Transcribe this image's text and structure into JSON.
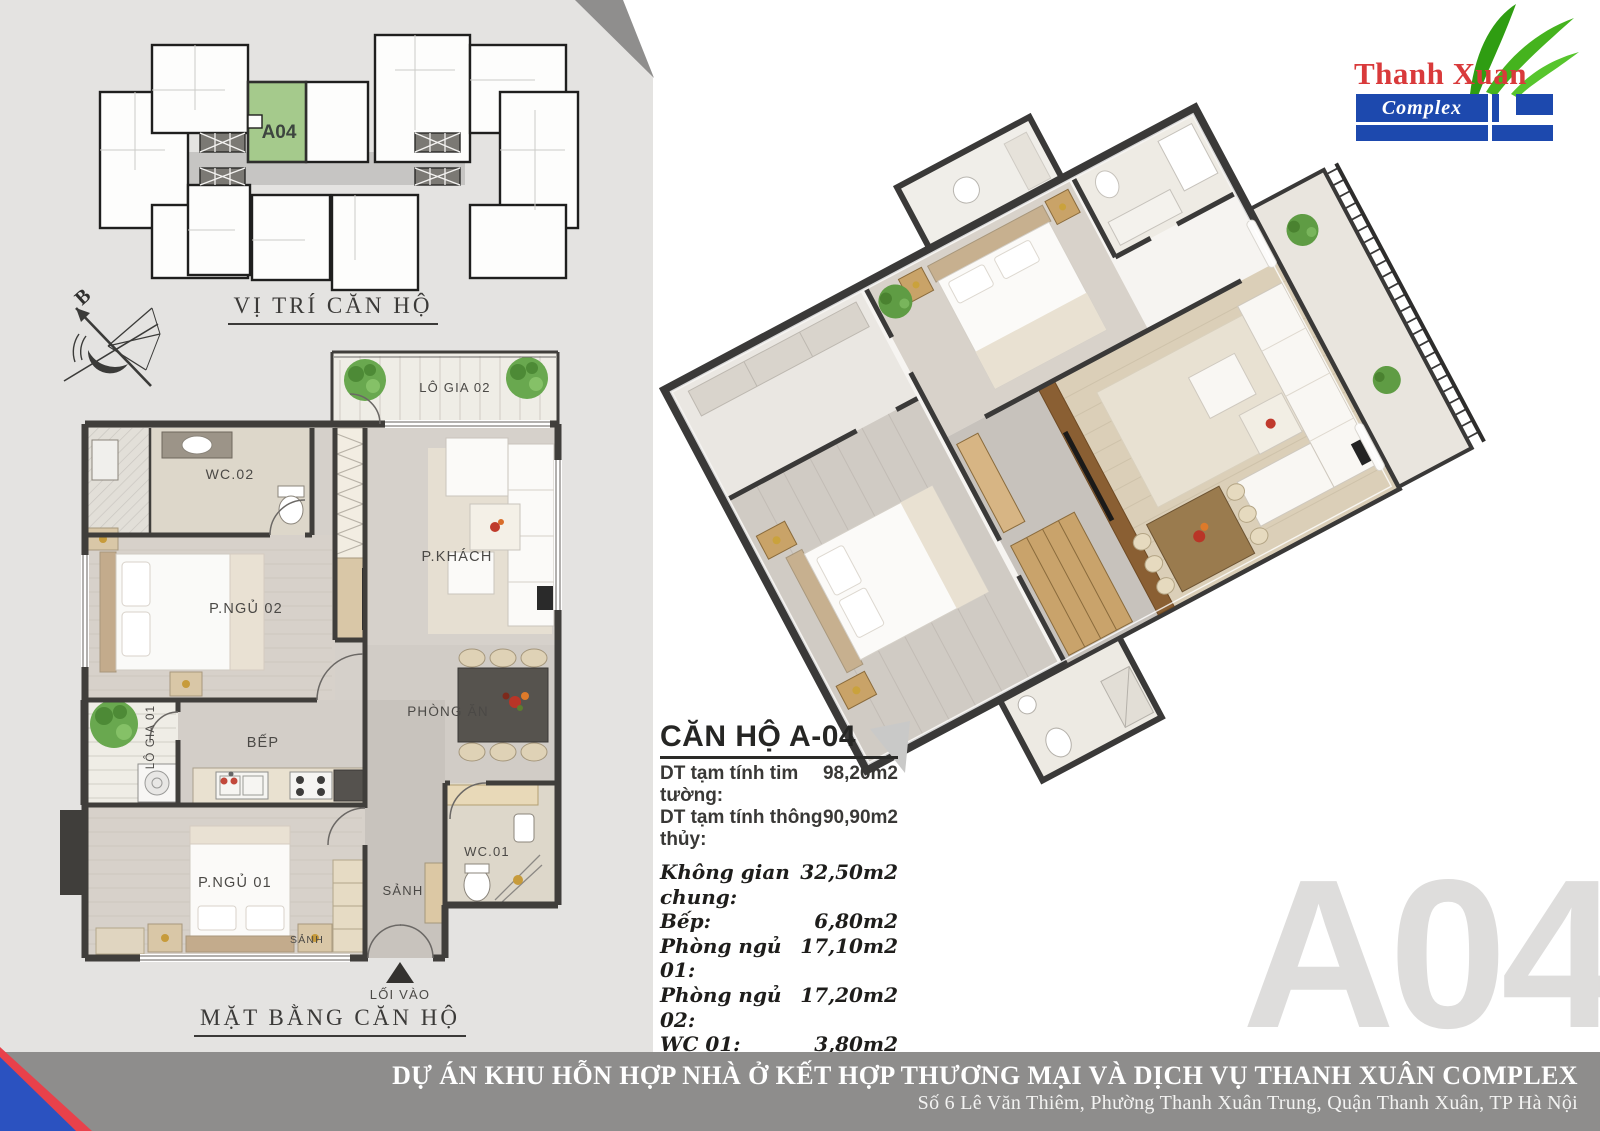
{
  "colors": {
    "panel_bg": "#e4e3e1",
    "banner_bg": "#8e8d8c",
    "logo_blue": "#1d49ae",
    "logo_red": "#d93a3b",
    "leaf_green": "#45b31e",
    "unit_highlight_green": "#a5ca8c",
    "corner_blue": "#2b52c0",
    "corner_red": "#e8414b",
    "watermark_gray": "#dedddc"
  },
  "logo": {
    "name": "Thanh Xuan",
    "sub": "Complex"
  },
  "location_map": {
    "title": "VỊ TRÍ CĂN HỘ",
    "highlighted_unit": "A04"
  },
  "compass": {
    "north_label": "B"
  },
  "floorplan": {
    "title": "MẶT BẰNG CĂN HỘ",
    "rooms": {
      "balcony2": "LÔ GIA 02",
      "wc2": "WC.02",
      "living": "P.KHÁCH",
      "bedroom2": "P.NGỦ 02",
      "dining": "PHÒNG ĂN",
      "kitchen": "BẾP",
      "balcony1": "LÔ GIA 01",
      "bedroom1": "P.NGỦ 01",
      "hall": "SẢNH",
      "hall_small": "SẢNH",
      "wc1": "WC.01",
      "entrance": "LỐI VÀO"
    }
  },
  "unit_info": {
    "title": "CĂN HỘ A-04",
    "rows": [
      {
        "label": "DT tạm tính tim tường:",
        "value": "98,20m2"
      },
      {
        "label": "DT tạm tính thông thủy:",
        "value": "90,90m2"
      }
    ],
    "areas": [
      {
        "label": "Không gian chung:",
        "value": "32,50m2"
      },
      {
        "label": "Bếp:",
        "value": "6,80m2"
      },
      {
        "label": "Phòng ngủ 01:",
        "value": "17,10m2"
      },
      {
        "label": "Phòng ngủ 02:",
        "value": "17,20m2"
      },
      {
        "label": "WC 01:",
        "value": "3,80m2"
      },
      {
        "label": "WC 02:",
        "value": "3,20m2"
      },
      {
        "label": "Lô gia 01:",
        "value": "4,30m2"
      },
      {
        "label": "Lô gia 02:",
        "value": "6,00m2"
      }
    ]
  },
  "watermark": "A04",
  "banner": {
    "line1": "DỰ ÁN KHU HỖN HỢP NHÀ Ở KẾT HỢP THƯƠNG MẠI VÀ DỊCH VỤ THANH XUÂN COMPLEX",
    "line2": "Số 6 Lê Văn Thiêm, Phường Thanh Xuân Trung, Quận Thanh Xuân, TP Hà Nội"
  }
}
